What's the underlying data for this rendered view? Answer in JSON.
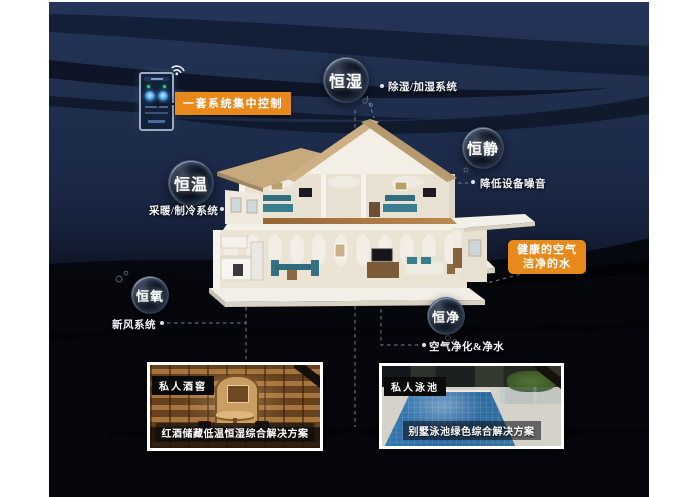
{
  "control": {
    "label": "一套系统集中控制"
  },
  "callout": {
    "line1": "健康的空气",
    "line2": "洁净的水"
  },
  "bubbles": {
    "humidity": {
      "label": "恒湿",
      "system": "除湿/加湿系统"
    },
    "quiet": {
      "label": "恒静",
      "system": "降低设备噪音"
    },
    "temperature": {
      "label": "恒温",
      "system": "采暖/制冷系统"
    },
    "oxygen": {
      "label": "恒氧",
      "system": "新风系统"
    },
    "purity": {
      "label": "恒净",
      "system": "空气净化&净水"
    }
  },
  "insets": {
    "wine": {
      "tag": "私人酒窖",
      "caption": "红酒储藏低温恒湿综合解决方案"
    },
    "pool": {
      "tag": "私人泳池",
      "caption": "别墅泳池绿色综合解决方案"
    }
  },
  "icons": {
    "wifi": "wifi-signal"
  },
  "colors": {
    "accent": "#e8891c",
    "bg_top": "#25345a",
    "bg_bottom": "#04060b",
    "bubble_text": "#ffffff"
  }
}
